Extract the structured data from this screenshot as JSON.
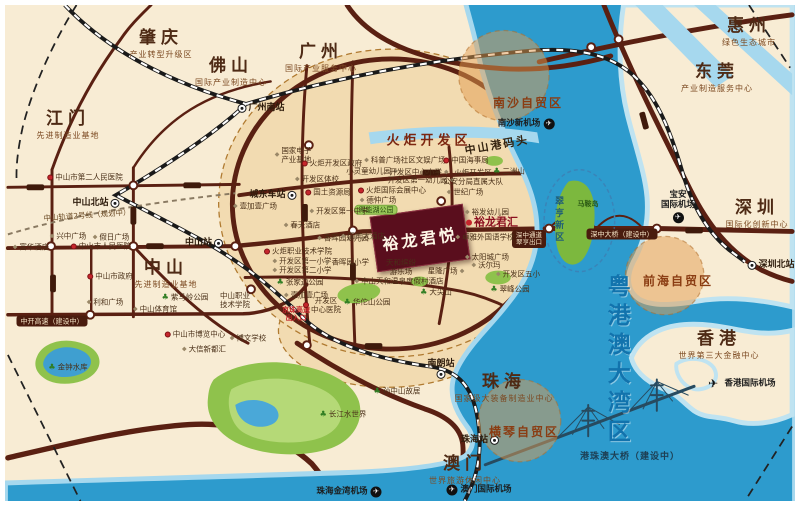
{
  "project": {
    "label": "裕龙君悦",
    "sister": "裕龙君汇"
  },
  "colors": {
    "land": "#f8ecd4",
    "water": "#2d9bcd",
    "water_light": "#a6d8ee",
    "road": "#5a2012",
    "dev_blob": "#f2dbb1",
    "zone_circle": "#e29b50",
    "project_bg": "#5a0e1d",
    "bay_text": "#1273ad",
    "park_green": "#8fc24c"
  },
  "cities": [
    {
      "name": "肇庆",
      "tagline": "产业转型升级区",
      "x": 156,
      "y": 39
    },
    {
      "name": "佛山",
      "tagline": "国际产业制造中心",
      "x": 226,
      "y": 67
    },
    {
      "name": "广州",
      "tagline": "国际产业服务中心",
      "x": 316,
      "y": 53
    },
    {
      "name": "江门",
      "tagline": "先进制造业基地",
      "x": 63,
      "y": 120
    },
    {
      "name": "惠州",
      "tagline": "绿色生态城市",
      "x": 744,
      "y": 27
    },
    {
      "name": "东莞",
      "tagline": "产业制造服务中心",
      "x": 712,
      "y": 73
    },
    {
      "name": "中山",
      "tagline": "先进制造业基地",
      "x": 161,
      "y": 269
    },
    {
      "name": "深圳",
      "tagline": "国际化创新中心",
      "x": 752,
      "y": 209
    },
    {
      "name": "香港",
      "tagline": "世界第三大金融中心",
      "x": 714,
      "y": 340
    },
    {
      "name": "珠海",
      "tagline": "国家级大装备制造业中心",
      "x": 499,
      "y": 383
    },
    {
      "name": "澳门",
      "tagline": "世界旅游休闲中心",
      "x": 460,
      "y": 465
    }
  ],
  "stations": [
    {
      "label": "广州南站",
      "x": 256,
      "y": 103,
      "side": "left"
    },
    {
      "label": "中山北站",
      "x": 91,
      "y": 198,
      "side": "right"
    },
    {
      "label": "中山站",
      "x": 199,
      "y": 238,
      "side": "right"
    },
    {
      "label": "城东车站",
      "x": 268,
      "y": 190,
      "side": "right"
    },
    {
      "label": "深圳北站",
      "x": 766,
      "y": 260,
      "side": "left"
    },
    {
      "label": "南朗站",
      "x": 436,
      "y": 364,
      "side": "below"
    },
    {
      "label": "珠海站",
      "x": 475,
      "y": 435,
      "side": "right"
    }
  ],
  "airports": [
    {
      "label": "南沙新机场",
      "x": 521,
      "y": 119,
      "side": "right"
    },
    {
      "label": "宝安国际机场",
      "lines": [
        "宝安",
        "国际机场"
      ],
      "x": 673,
      "y": 202,
      "side": "below"
    },
    {
      "label": "香港国际机场",
      "x": 735,
      "y": 379,
      "side": "left",
      "big": true
    },
    {
      "label": "珠海金湾机场",
      "x": 344,
      "y": 487,
      "side": "right"
    },
    {
      "label": "澳门国际机场",
      "x": 474,
      "y": 485,
      "side": "left"
    }
  ],
  "zones": [
    {
      "label": "南沙自贸区",
      "x": 523,
      "y": 99
    },
    {
      "label": "前海自贸区",
      "x": 673,
      "y": 277
    },
    {
      "label": "横琴自贸区",
      "x": 519,
      "y": 428
    }
  ],
  "banners": [
    {
      "label": "深中大桥（建设中）",
      "style": "pill",
      "x": 617,
      "y": 229
    },
    {
      "label": "中开高速（建设中）",
      "style": "pill",
      "x": 47,
      "y": 316
    },
    {
      "label": "深中通道 翠亨出口",
      "lines": [
        "深中通道",
        "翠亨出口"
      ],
      "style": "pill",
      "x": 524,
      "y": 234
    },
    {
      "label": "港珠澳大桥（建设中）",
      "style": "navy",
      "x": 625,
      "y": 452
    },
    {
      "label": "京珠高速出入口",
      "lines": [
        "京珠高速",
        "出入口"
      ],
      "style": "red",
      "x": 291,
      "y": 309
    },
    {
      "label": "中山轨道2号线（规划中）",
      "style": "note",
      "x": 82,
      "y": 211
    }
  ],
  "area_titles": [
    {
      "label": "火炬开发区",
      "cls": "t-torch",
      "x": 424,
      "y": 137
    },
    {
      "label": "中山港码头",
      "cls": "t-port",
      "x": 492,
      "y": 141
    },
    {
      "label": "翠亨新区",
      "cls": "t-cuiheng",
      "x": 553,
      "y": 215
    },
    {
      "label": "粤港澳大湾区",
      "cls": "t-bay",
      "x": 611,
      "y": 356
    },
    {
      "label": "马鞍岛",
      "cls": "t-island",
      "x": 583,
      "y": 199
    }
  ],
  "pois": [
    {
      "label": "中山市第二人民医院",
      "x": 80,
      "y": 172,
      "icon": "red"
    },
    {
      "label": "兴中广场",
      "x": 63,
      "y": 231,
      "icon": "grey"
    },
    {
      "label": "假日广场",
      "x": 106,
      "y": 232,
      "icon": "grey"
    },
    {
      "label": "富华酒店",
      "x": 26,
      "y": 242,
      "icon": "grey"
    },
    {
      "label": "中山市人民医院",
      "x": 96,
      "y": 241,
      "icon": "red"
    },
    {
      "label": "中山市政府",
      "x": 105,
      "y": 271,
      "icon": "red"
    },
    {
      "label": "利和广场",
      "x": 100,
      "y": 297,
      "icon": "grey"
    },
    {
      "label": "紫马岭公园",
      "x": 180,
      "y": 292,
      "icon": "green"
    },
    {
      "label": "中山体育馆",
      "x": 150,
      "y": 304,
      "icon": "grey"
    },
    {
      "label": "中山职业技术学院",
      "lines": [
        "中山职业",
        "技术学院"
      ],
      "x": 230,
      "y": 295,
      "icon": "none"
    },
    {
      "label": "中山市博览中心",
      "x": 190,
      "y": 329,
      "icon": "red"
    },
    {
      "label": "大信新都汇",
      "x": 199,
      "y": 344,
      "icon": "grey"
    },
    {
      "label": "博文学校",
      "x": 243,
      "y": 333,
      "icon": "grey"
    },
    {
      "label": "金钟水库",
      "x": 63,
      "y": 362,
      "icon": "green"
    },
    {
      "label": "孙中山故居",
      "x": 392,
      "y": 386,
      "icon": "green"
    },
    {
      "label": "长江水世界",
      "x": 338,
      "y": 409,
      "icon": "green"
    },
    {
      "label": "国家电子产业基地",
      "lines": [
        "国家电子",
        "产业基地"
      ],
      "x": 288,
      "y": 150,
      "icon": "grey"
    },
    {
      "label": "火炬开发区政府",
      "x": 327,
      "y": 158,
      "icon": "red"
    },
    {
      "label": "开发区体校",
      "x": 312,
      "y": 174,
      "icon": "grey"
    },
    {
      "label": "国土资源局",
      "x": 323,
      "y": 187,
      "icon": "red"
    },
    {
      "label": "火炬国际会展中心",
      "x": 387,
      "y": 185,
      "icon": "red"
    },
    {
      "label": "德仲广场",
      "x": 373,
      "y": 195,
      "icon": "grey"
    },
    {
      "label": "得能湖公园",
      "x": 371,
      "y": 205,
      "icon": "pill"
    },
    {
      "label": "科普广场社区文娱广场",
      "x": 400,
      "y": 155,
      "icon": "grey"
    },
    {
      "label": "小灵童幼儿园",
      "x": 367,
      "y": 166,
      "icon": "grey",
      "side": "right"
    },
    {
      "label": "开发区中心小学",
      "x": 414,
      "y": 167,
      "icon": "grey",
      "side": "right"
    },
    {
      "label": "开发区第一幼儿园",
      "x": 416,
      "y": 175,
      "icon": "grey",
      "side": "right"
    },
    {
      "label": "中国海事局",
      "x": 461,
      "y": 155,
      "icon": "red"
    },
    {
      "label": "火炬开发区公安分局直属大队",
      "lines": [
        "火炬开发区",
        "公安分局直属大队"
      ],
      "x": 468,
      "y": 172,
      "icon": "none"
    },
    {
      "label": "二洲山",
      "x": 504,
      "y": 166,
      "icon": "green"
    },
    {
      "label": "世纪广场",
      "x": 460,
      "y": 187,
      "icon": "grey"
    },
    {
      "label": "裕发幼儿园",
      "x": 482,
      "y": 207,
      "icon": "grey"
    },
    {
      "label": "卓雅外国语学校",
      "x": 480,
      "y": 232,
      "icon": "grey"
    },
    {
      "label": "太阳城广场",
      "x": 482,
      "y": 252,
      "icon": "grey"
    },
    {
      "label": "沃尔玛",
      "x": 481,
      "y": 260,
      "icon": "grey"
    },
    {
      "label": "星隆广场",
      "x": 441,
      "y": 266,
      "icon": "grey",
      "side": "right"
    },
    {
      "label": "开发区五小",
      "x": 513,
      "y": 269,
      "icon": "grey"
    },
    {
      "label": "翠峰公园",
      "x": 505,
      "y": 284,
      "icon": "green"
    },
    {
      "label": "大尖山",
      "x": 431,
      "y": 287,
      "icon": "green"
    },
    {
      "label": "华佗山公园",
      "x": 362,
      "y": 297,
      "icon": "green"
    },
    {
      "label": "开发区中心医院",
      "lines": [
        "开发区",
        "中心医院"
      ],
      "x": 317,
      "y": 300,
      "icon": "red"
    },
    {
      "label": "开发区第一中学",
      "x": 334,
      "y": 206,
      "icon": "grey"
    },
    {
      "label": "春天酒店",
      "x": 297,
      "y": 220,
      "icon": "grey"
    },
    {
      "label": "火炬职业技术学院",
      "x": 293,
      "y": 246,
      "icon": "red"
    },
    {
      "label": "开发区第一小学",
      "x": 297,
      "y": 256,
      "icon": "grey"
    },
    {
      "label": "开发区第二小学",
      "x": 297,
      "y": 265,
      "icon": "grey"
    },
    {
      "label": "香晖园幼儿园",
      "x": 338,
      "y": 233,
      "icon": "grey"
    },
    {
      "label": "香晖园小学",
      "x": 342,
      "y": 257,
      "icon": "grey"
    },
    {
      "label": "国宾大酒店",
      "x": 358,
      "y": 231,
      "icon": "grey"
    },
    {
      "label": "天和缤纷游乐场",
      "lines": [
        "天和缤纷",
        "游乐场"
      ],
      "x": 396,
      "y": 262,
      "icon": "none"
    },
    {
      "label": "中山天和温泉度假村酒店",
      "x": 394,
      "y": 276,
      "icon": "grey"
    },
    {
      "label": "张家边公园",
      "x": 295,
      "y": 277,
      "icon": "green"
    },
    {
      "label": "壹加壹广场",
      "x": 250,
      "y": 201,
      "icon": "grey"
    },
    {
      "label": "壹加壹广场",
      "x": 301,
      "y": 290,
      "icon": "grey"
    }
  ]
}
